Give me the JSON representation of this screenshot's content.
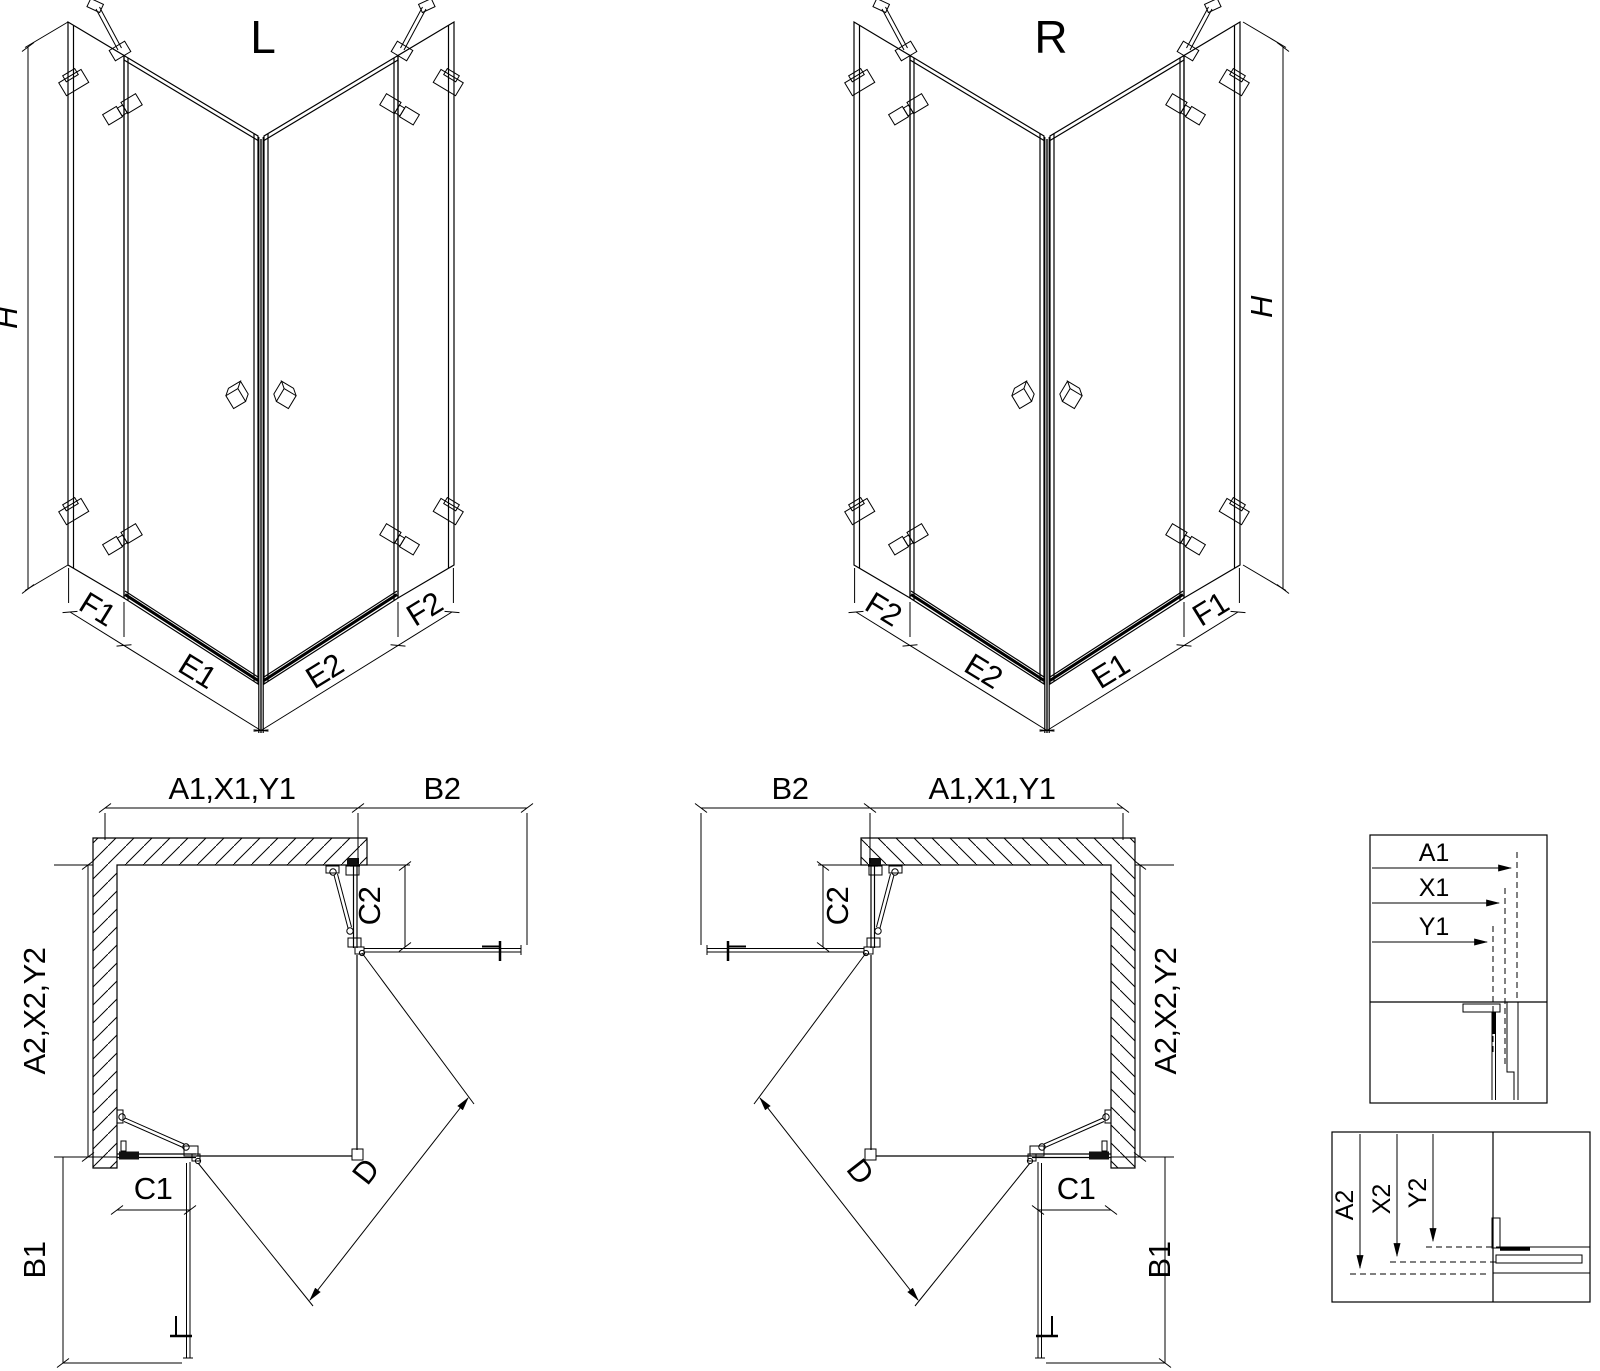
{
  "page": {
    "background": "#ffffff",
    "line_color": "#000000"
  },
  "iso_left": {
    "title": "L",
    "height_dim": "H",
    "dims": {
      "f1": "F1",
      "e1": "E1",
      "e2": "E2",
      "f2": "F2"
    }
  },
  "iso_right": {
    "title": "R",
    "height_dim": "H",
    "dims": {
      "f2": "F2",
      "e2": "E2",
      "e1": "E1",
      "f1": "F1"
    }
  },
  "plan_left": {
    "width_top": "A1,X1,Y1",
    "door_width_top": "B2",
    "depth_side": "A2,X2,Y2",
    "fixed_width_top": "C2",
    "fixed_width_side": "C1",
    "door_width_side": "B1",
    "diagonal": "D"
  },
  "plan_right": {
    "width_top": "A1,X1,Y1",
    "door_width_top": "B2",
    "depth_side": "A2,X2,Y2",
    "fixed_width_top": "C2",
    "fixed_width_side": "C1",
    "door_width_side": "B1",
    "diagonal": "D"
  },
  "detail_width": {
    "a1": "A1",
    "x1": "X1",
    "y1": "Y1"
  },
  "detail_depth": {
    "a2": "A2",
    "x2": "X2",
    "y2": "Y2"
  }
}
